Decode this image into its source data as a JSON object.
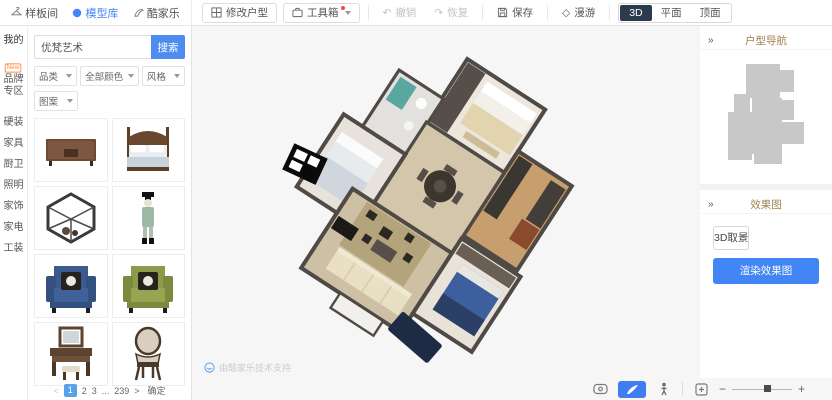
{
  "top_bar": {
    "tabs": [
      {
        "label": "样板间"
      },
      {
        "label": "模型库"
      },
      {
        "label": "酷家乐"
      }
    ],
    "modify_label": "修改户型",
    "toolbox_label": "工具箱",
    "undo_label": "撤销",
    "redo_label": "恢复",
    "save_label": "保存",
    "roam_label": "漫游",
    "view_modes": [
      {
        "label": "3D"
      },
      {
        "label": "平面"
      },
      {
        "label": "顶面"
      }
    ],
    "active_view": "3D"
  },
  "sidebar": {
    "items": [
      {
        "label": "我的"
      },
      {
        "label": "品牌专区",
        "badge": "New"
      },
      {
        "label": "硬装"
      },
      {
        "label": "家具"
      },
      {
        "label": "厨卫"
      },
      {
        "label": "照明"
      },
      {
        "label": "家饰"
      },
      {
        "label": "家电"
      },
      {
        "label": "工装"
      }
    ]
  },
  "library": {
    "search_value": "优梵艺术",
    "search_button": "搜索",
    "filters": [
      {
        "label": "品类"
      },
      {
        "label": "全部颜色"
      },
      {
        "label": "风格"
      },
      {
        "label": "图案"
      }
    ],
    "products": [
      {
        "name": "wooden-tv-cabinet"
      },
      {
        "name": "four-poster-bed"
      },
      {
        "name": "geometric-shelf"
      },
      {
        "name": "figurine"
      },
      {
        "name": "blue-armchair"
      },
      {
        "name": "green-armchair"
      },
      {
        "name": "dressing-table"
      },
      {
        "name": "upholstered-chair"
      }
    ],
    "pagination": {
      "prev": "<",
      "pages": [
        "1",
        "2",
        "3",
        "...",
        "239"
      ],
      "active_page": "1",
      "next": ">",
      "confirm_label": "确定"
    }
  },
  "canvas": {
    "watermark": "由酷家乐技术支持"
  },
  "right_panel": {
    "collapse_icon": "»",
    "nav_title": "户型导航",
    "render_title": "效果图",
    "capture_button": "3D取景",
    "render_button": "渲染效果图"
  },
  "zoom_bar": {
    "minus": "−",
    "plus": "+"
  },
  "colors": {
    "accent_blue": "#4285f4",
    "active_dark": "#2b3a4d",
    "badge_orange": "#ff8c3c",
    "active_page_blue": "#57a3e8"
  }
}
